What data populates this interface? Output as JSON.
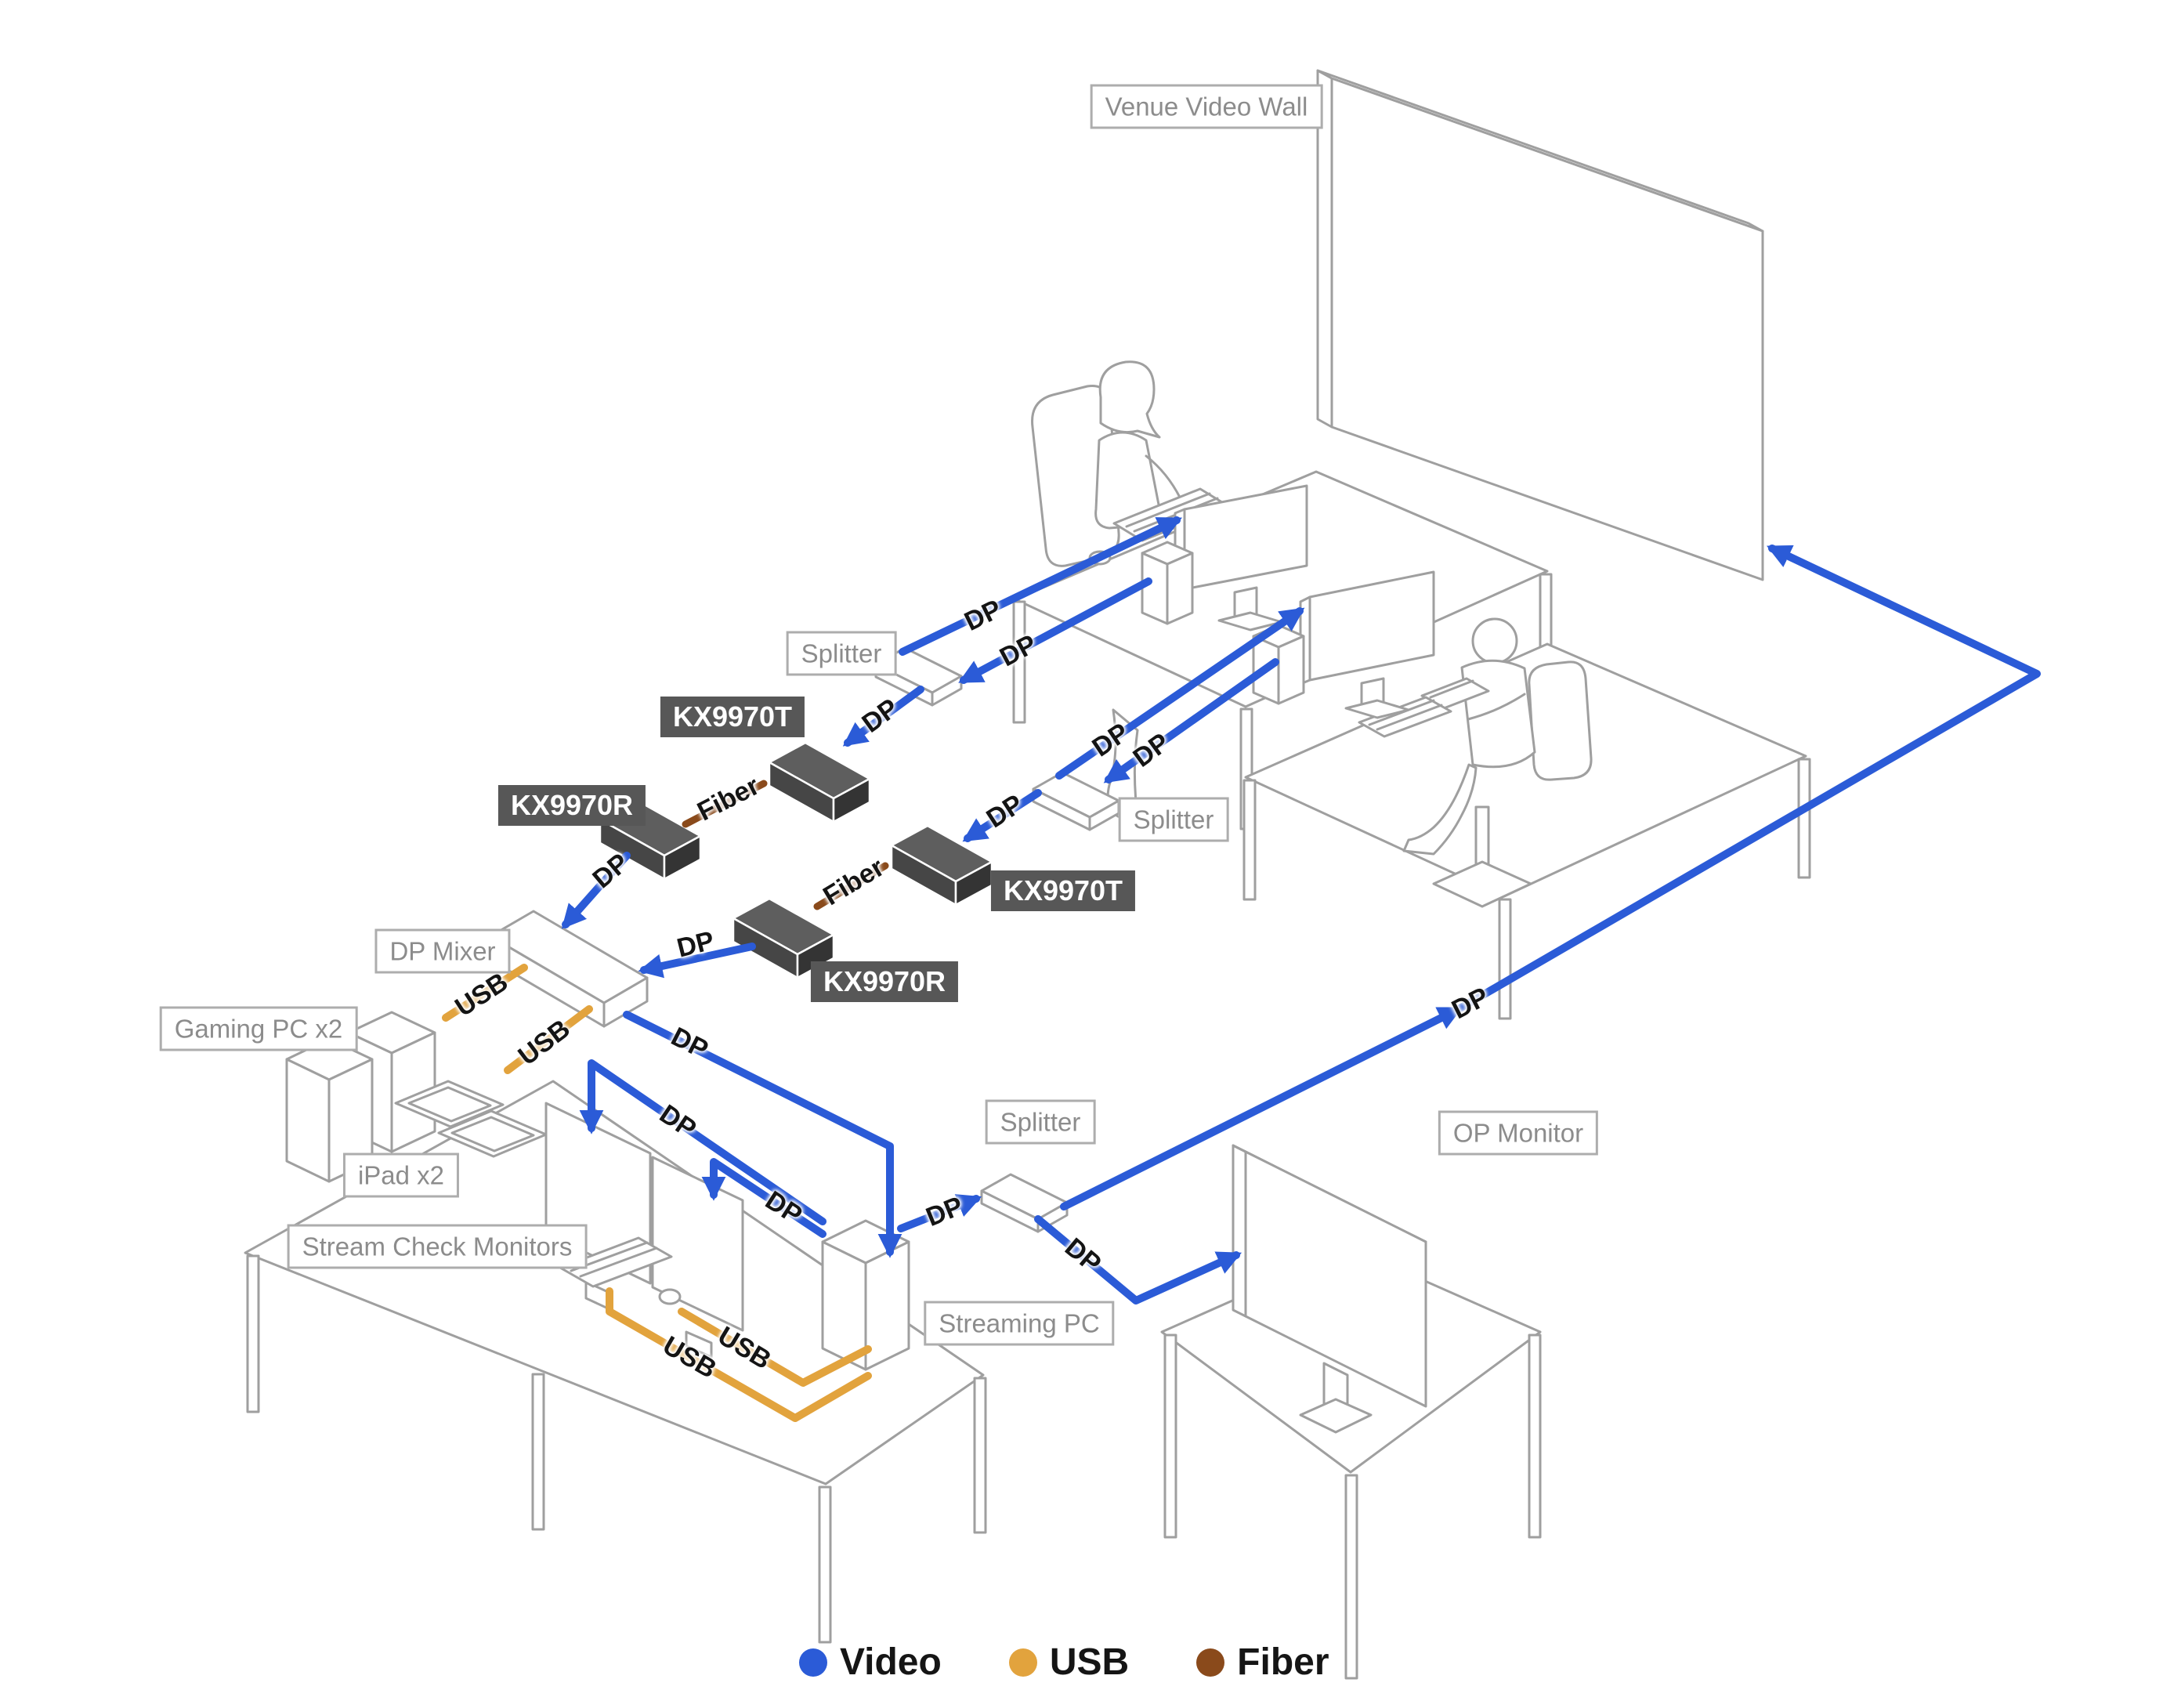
{
  "diagram": {
    "boxed_labels": {
      "venue_video_wall": "Venue Video Wall",
      "splitter": "Splitter",
      "dp_mixer": "DP Mixer",
      "gaming_pc": "Gaming PC x2",
      "ipad": "iPad x2",
      "stream_check_monitors": "Stream Check Monitors",
      "streaming_pc": "Streaming PC",
      "op_monitor": "OP Monitor"
    },
    "device_tags": {
      "kx9970t": "KX9970T",
      "kx9970r": "KX9970R"
    },
    "cable_labels": {
      "dp": "DP",
      "usb": "USB",
      "fiber": "Fiber"
    },
    "legend": {
      "items": [
        {
          "label": "Video",
          "color": "#2B5BD7"
        },
        {
          "label": "USB",
          "color": "#E2A33D"
        },
        {
          "label": "Fiber",
          "color": "#8A4A1B"
        }
      ]
    },
    "colors": {
      "video_cable": "#2B5BD7",
      "usb_cable": "#E2A33D",
      "fiber_cable": "#8A4A1B",
      "outline": "#9F9F9F",
      "device_box": "#5E5E5E",
      "label_text": "#8C8C8C"
    }
  }
}
